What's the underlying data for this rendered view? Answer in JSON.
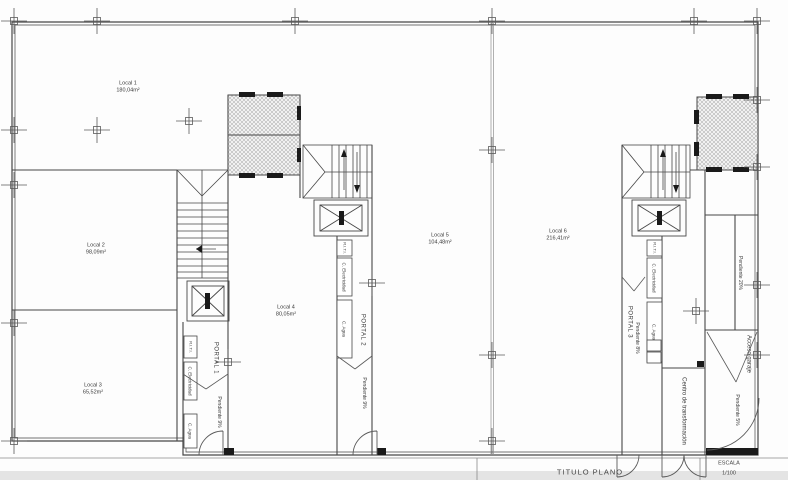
{
  "drawing": {
    "locals": [
      {
        "name": "Local 1",
        "area": "180,04m²"
      },
      {
        "name": "Local 2",
        "area": "98,09m²"
      },
      {
        "name": "Local 3",
        "area": "65,52m²"
      },
      {
        "name": "Local 4",
        "area": "80,05m²"
      },
      {
        "name": "Local 5",
        "area": "104,48m²"
      },
      {
        "name": "Local 6",
        "area": "216,41m²"
      }
    ],
    "portals": [
      {
        "name": "PORTAL 1",
        "slope": "Pendiente 9%"
      },
      {
        "name": "PORTAL 2",
        "slope": "Pendiente 9%"
      },
      {
        "name": "PORTAL 3",
        "slope": "Pendiente 8%"
      }
    ],
    "services": {
      "riti": "R.I.T.I.",
      "electricity": "C. Electricidad",
      "water": "C. Agua"
    },
    "annotations": {
      "transformer": "Centro de transformación",
      "garage_access": "Acceso garaje",
      "garage_slope": "Pendiente 5%",
      "ramp_slope": "Pendiente 20%"
    },
    "title_block": {
      "title_label": "TITULO  PLANO",
      "scale_label": "ESCALA",
      "scale_value": "1/100"
    },
    "colors": {
      "line": "#4a4a4a",
      "hatch": "#a5a5a5",
      "paper": "#ffffff"
    }
  }
}
